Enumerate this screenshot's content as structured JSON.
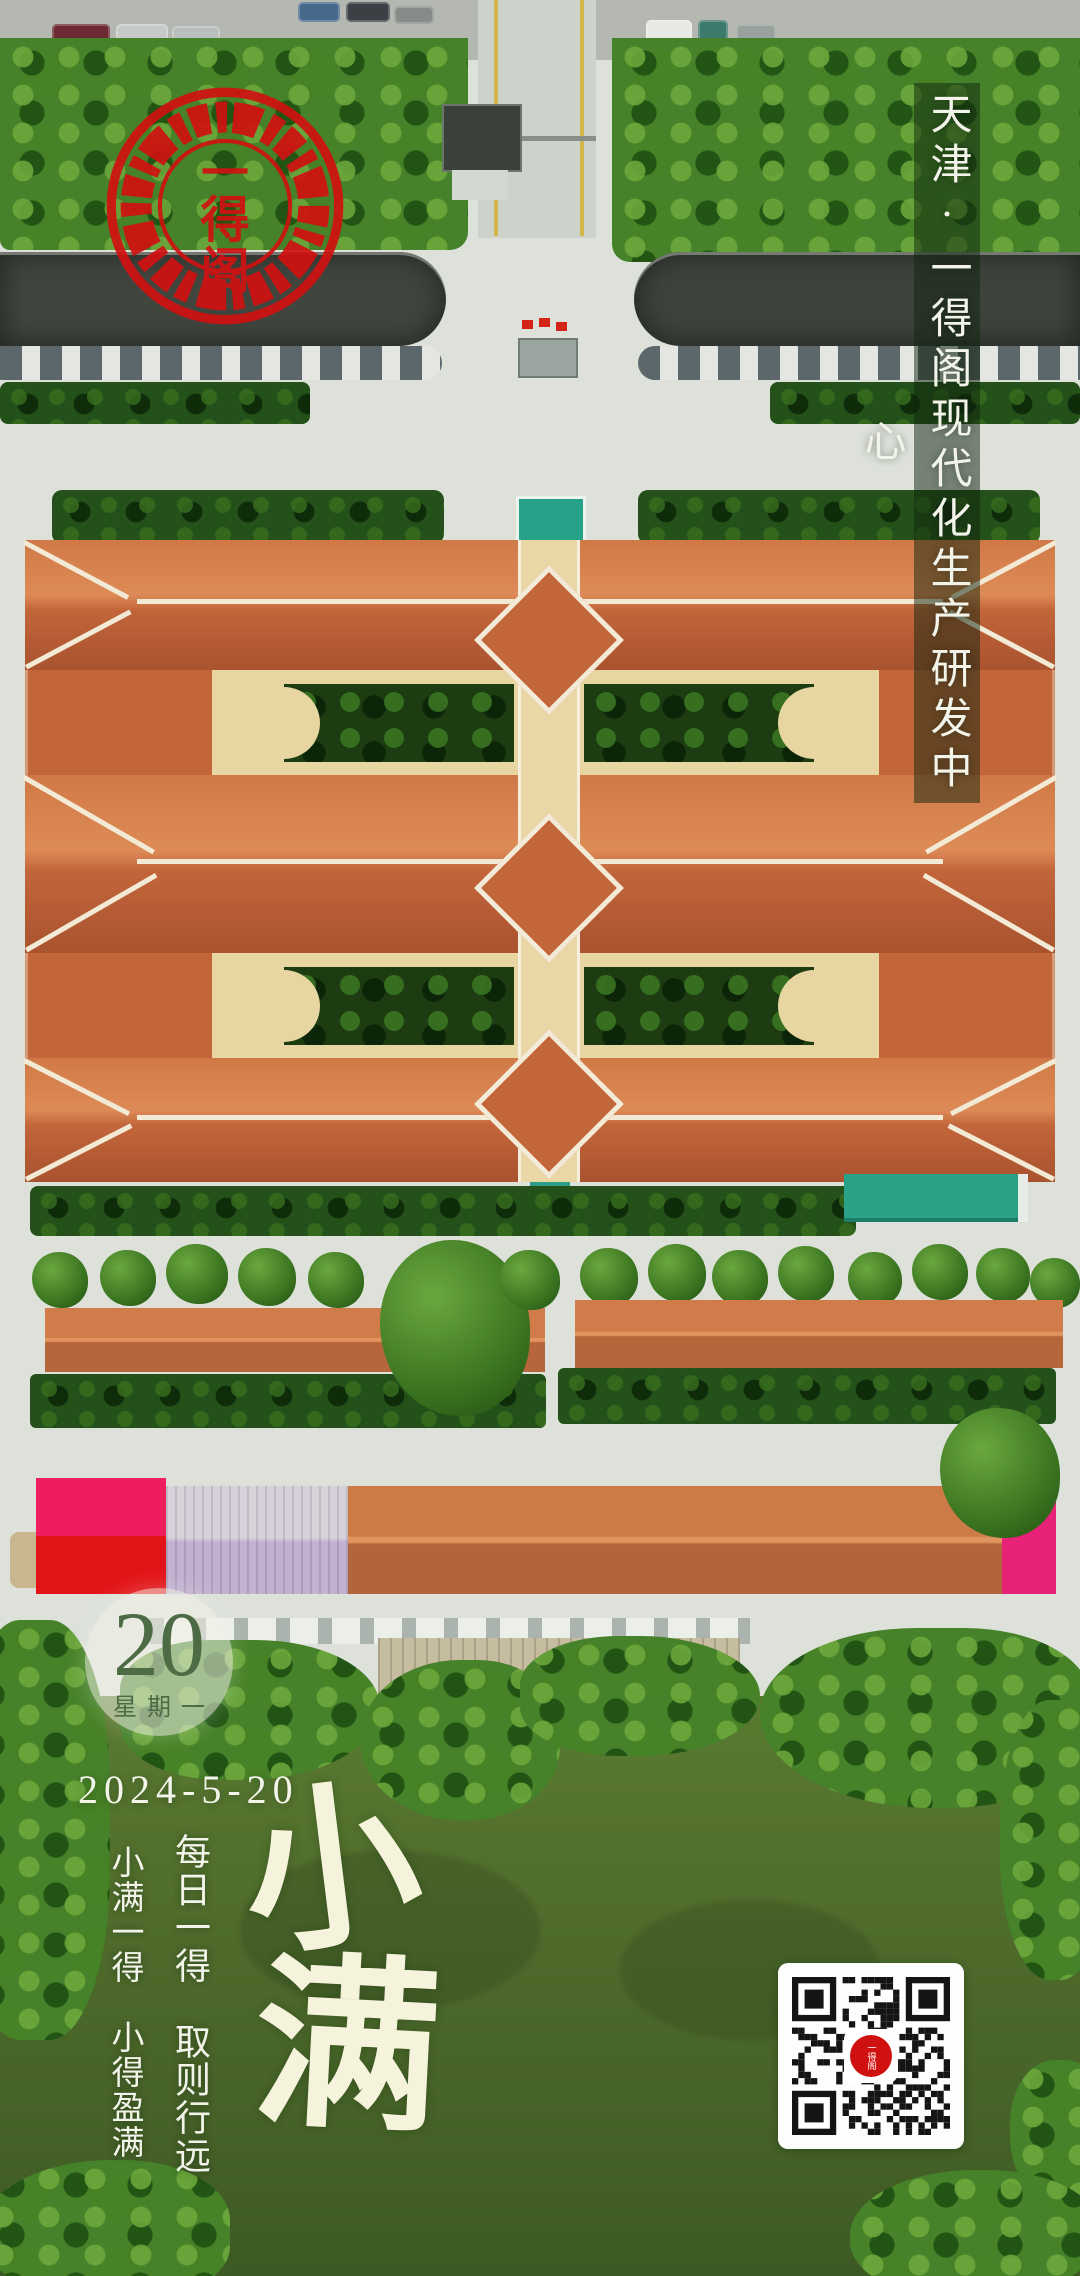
{
  "poster": {
    "location_title": "天津·一得阁现代化生产研发中心",
    "seal": {
      "characters": [
        "一",
        "得",
        "阁"
      ]
    },
    "calendar": {
      "day": "20",
      "weekday": "星期一",
      "date": "2024-5-20"
    },
    "solar_term": {
      "name": "小满",
      "char_top": "小",
      "char_bottom": "满"
    },
    "slogans": {
      "daily": "每日一得　取则行远",
      "term": "小满一得　小得盈满"
    },
    "qr_code": {
      "center_logo_chars": "一得阁"
    },
    "colors": {
      "seal_red": "#d01111",
      "roof_orange": "#c2663a",
      "ridge_cream": "#f3ead5",
      "courtyard_cream": "#e7d6a1",
      "pond_green": "#4f6d2b",
      "tree_green": "#3f7a22",
      "teal_canopy": "#2aa189",
      "warehouse_pink": "#ee1e5e",
      "warehouse_red": "#e21417",
      "warehouse_magenta": "#e72277",
      "date_green": "#4d6b44",
      "text_white": "#f4f4ea"
    }
  }
}
